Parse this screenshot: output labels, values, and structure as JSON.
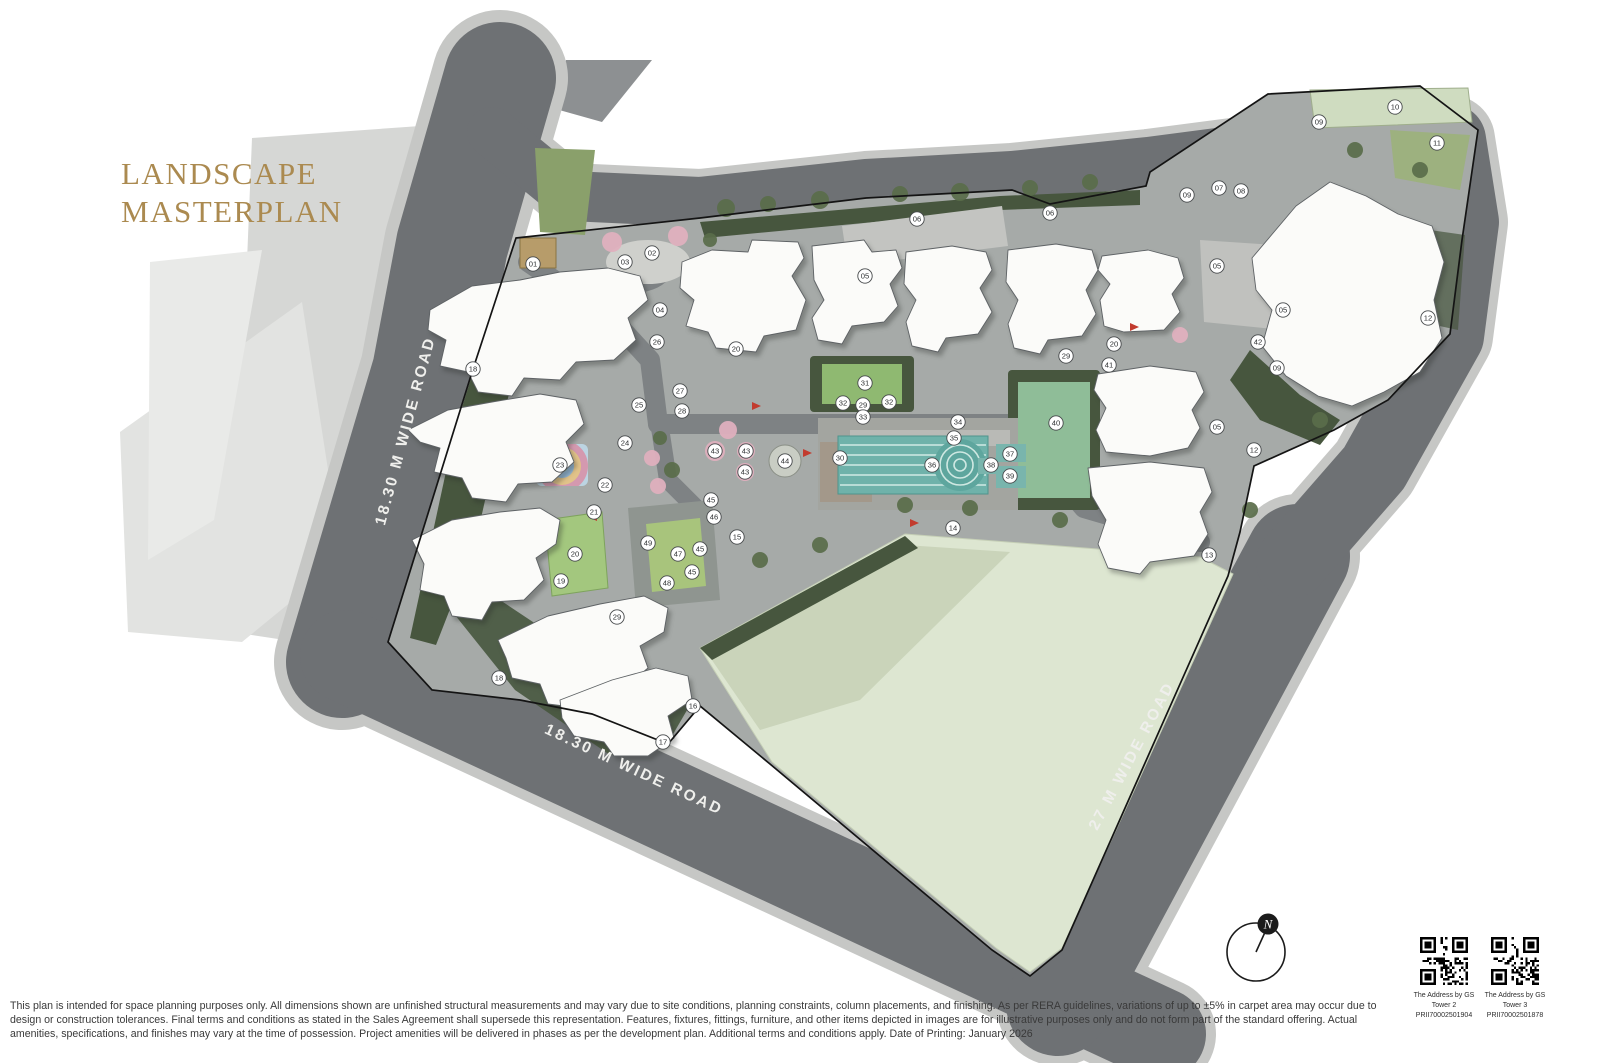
{
  "title": {
    "line1": "LANDSCAPE",
    "line2": "MASTERPLAN"
  },
  "roads": {
    "left": "18.30 M WIDE ROAD",
    "bottom": "18.30 M WIDE ROAD",
    "right": "27 M WIDE ROAD"
  },
  "compass": {
    "label": "N"
  },
  "qr": [
    {
      "line1": "The Address by GS",
      "line2": "Tower 2",
      "line3": "PRII70002501904"
    },
    {
      "line1": "The Address by GS",
      "line2": "Tower 3",
      "line3": "PRII70002501878"
    }
  ],
  "disclaimer": "This plan is intended for space planning purposes only. All dimensions shown are unfinished structural measurements and may vary due to site conditions, planning constraints, column placements, and finishing. As per RERA guidelines, variations of up to ±5% in carpet area may occur due to design or construction tolerances. Final terms and conditions as stated in the Sales Agreement shall supersede this representation. Features, fixtures, fittings, furniture, and other items depicted in images are for illustrative purposes only and do not form part of the standard offering. Actual amenities, specifications, and finishes may vary at the time of possession. Project amenities will be delivered in phases as per the development plan. Additional terms and conditions apply. Date of Printing: January 2026",
  "colors": {
    "accent_gold": "#ab8a50",
    "road": "#6e7174",
    "sidewalk": "#c6c7c5",
    "boundary": "#141414",
    "pool": "#6fb2aa",
    "lawn": "#a3c77e",
    "field": "#dde6d1",
    "hedge": "#47563e",
    "building": "#fbfbf9"
  },
  "plan": {
    "markers": [
      {
        "n": "01",
        "x": 533,
        "y": 264
      },
      {
        "n": "02",
        "x": 652,
        "y": 253
      },
      {
        "n": "03",
        "x": 625,
        "y": 262
      },
      {
        "n": "04",
        "x": 660,
        "y": 310
      },
      {
        "n": "05",
        "x": 865,
        "y": 276
      },
      {
        "n": "05",
        "x": 1217,
        "y": 266
      },
      {
        "n": "05",
        "x": 1283,
        "y": 310
      },
      {
        "n": "05",
        "x": 1217,
        "y": 427
      },
      {
        "n": "06",
        "x": 917,
        "y": 219
      },
      {
        "n": "06",
        "x": 1050,
        "y": 213
      },
      {
        "n": "07",
        "x": 1219,
        "y": 188
      },
      {
        "n": "08",
        "x": 1241,
        "y": 191
      },
      {
        "n": "09",
        "x": 1187,
        "y": 195
      },
      {
        "n": "09",
        "x": 1319,
        "y": 122
      },
      {
        "n": "09",
        "x": 1277,
        "y": 368
      },
      {
        "n": "10",
        "x": 1395,
        "y": 107
      },
      {
        "n": "11",
        "x": 1437,
        "y": 143
      },
      {
        "n": "12",
        "x": 1428,
        "y": 318
      },
      {
        "n": "12",
        "x": 1254,
        "y": 450
      },
      {
        "n": "13",
        "x": 1209,
        "y": 555
      },
      {
        "n": "14",
        "x": 953,
        "y": 528
      },
      {
        "n": "15",
        "x": 737,
        "y": 537
      },
      {
        "n": "16",
        "x": 693,
        "y": 706
      },
      {
        "n": "17",
        "x": 663,
        "y": 742
      },
      {
        "n": "18",
        "x": 473,
        "y": 369
      },
      {
        "n": "18",
        "x": 499,
        "y": 678
      },
      {
        "n": "19",
        "x": 561,
        "y": 581
      },
      {
        "n": "20",
        "x": 575,
        "y": 554
      },
      {
        "n": "20",
        "x": 736,
        "y": 349
      },
      {
        "n": "20",
        "x": 1114,
        "y": 344
      },
      {
        "n": "21",
        "x": 594,
        "y": 512
      },
      {
        "n": "22",
        "x": 605,
        "y": 485
      },
      {
        "n": "23",
        "x": 560,
        "y": 465
      },
      {
        "n": "24",
        "x": 625,
        "y": 443
      },
      {
        "n": "25",
        "x": 639,
        "y": 405
      },
      {
        "n": "26",
        "x": 657,
        "y": 342
      },
      {
        "n": "27",
        "x": 680,
        "y": 391
      },
      {
        "n": "28",
        "x": 682,
        "y": 411
      },
      {
        "n": "29",
        "x": 863,
        "y": 405
      },
      {
        "n": "29",
        "x": 1066,
        "y": 356
      },
      {
        "n": "29",
        "x": 617,
        "y": 617
      },
      {
        "n": "30",
        "x": 840,
        "y": 458
      },
      {
        "n": "31",
        "x": 865,
        "y": 383
      },
      {
        "n": "32",
        "x": 843,
        "y": 403
      },
      {
        "n": "32",
        "x": 889,
        "y": 402
      },
      {
        "n": "33",
        "x": 863,
        "y": 417
      },
      {
        "n": "34",
        "x": 958,
        "y": 422
      },
      {
        "n": "35",
        "x": 954,
        "y": 438
      },
      {
        "n": "36",
        "x": 932,
        "y": 465
      },
      {
        "n": "37",
        "x": 1010,
        "y": 454
      },
      {
        "n": "38",
        "x": 991,
        "y": 465
      },
      {
        "n": "39",
        "x": 1010,
        "y": 476
      },
      {
        "n": "40",
        "x": 1056,
        "y": 423
      },
      {
        "n": "41",
        "x": 1109,
        "y": 365
      },
      {
        "n": "42",
        "x": 1258,
        "y": 342
      },
      {
        "n": "43",
        "x": 715,
        "y": 451
      },
      {
        "n": "43",
        "x": 746,
        "y": 451
      },
      {
        "n": "43",
        "x": 745,
        "y": 472
      },
      {
        "n": "44",
        "x": 785,
        "y": 461
      },
      {
        "n": "45",
        "x": 711,
        "y": 500
      },
      {
        "n": "45",
        "x": 700,
        "y": 549
      },
      {
        "n": "45",
        "x": 692,
        "y": 572
      },
      {
        "n": "46",
        "x": 714,
        "y": 517
      },
      {
        "n": "47",
        "x": 678,
        "y": 554
      },
      {
        "n": "48",
        "x": 667,
        "y": 583
      },
      {
        "n": "49",
        "x": 648,
        "y": 543
      }
    ]
  }
}
